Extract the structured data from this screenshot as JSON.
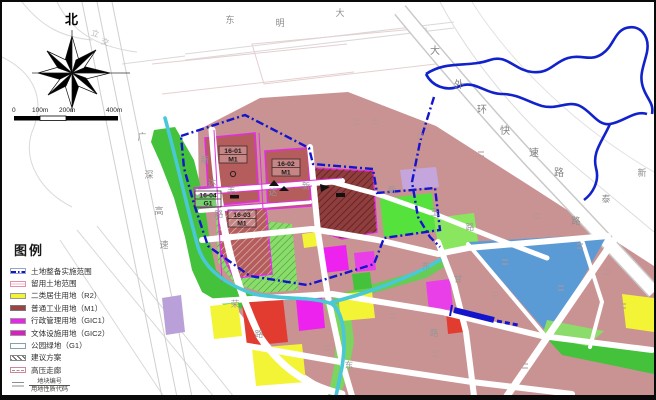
{
  "compass": {
    "north": "北"
  },
  "scalebar": {
    "labels": [
      "0",
      "100m",
      "200m",
      "400m"
    ]
  },
  "legend": {
    "title": "图例",
    "items": [
      {
        "label": "土地整备实施范围",
        "type": "dashdot-line",
        "color": "#1414cc"
      },
      {
        "label": "留用土地范围",
        "type": "outline-pink",
        "color": "#e590a8"
      },
      {
        "label": "二类居住用地（R2）",
        "type": "fill",
        "color": "#f4f436"
      },
      {
        "label": "普通工业用地（M1）",
        "type": "fill",
        "color": "#9c4444"
      },
      {
        "label": "行政管理用地（GIC1）",
        "type": "fill",
        "color": "#ee22ee"
      },
      {
        "label": "文体设施用地（GIC2）",
        "type": "fill",
        "color": "#de1cc6"
      },
      {
        "label": "公园绿地（G1）",
        "type": "outline",
        "color": "#fdfdfd"
      },
      {
        "label": "建议方案",
        "type": "hatch",
        "color": "#555555"
      },
      {
        "label": "高压走廊",
        "type": "outline-dash",
        "color": "#cc8899"
      },
      {
        "label_top": "地块编号",
        "label_bottom": "用地性质代码",
        "type": "fraction"
      }
    ]
  },
  "map": {
    "plots": [
      {
        "id": "16-01",
        "code": "M1"
      },
      {
        "id": "16-02",
        "code": "M1"
      },
      {
        "id": "16-03",
        "code": "M1"
      },
      {
        "id": "16-04",
        "code": "G1"
      }
    ],
    "road_labels": [
      {
        "ch": "东"
      },
      {
        "ch": "明"
      },
      {
        "ch": "大"
      },
      {
        "ch": "大"
      },
      {
        "ch": "外"
      },
      {
        "ch": "环"
      },
      {
        "ch": "快"
      },
      {
        "ch": "速"
      },
      {
        "ch": "路"
      },
      {
        "ch": "新"
      },
      {
        "ch": "泰"
      },
      {
        "ch": "路"
      },
      {
        "ch": "广"
      },
      {
        "ch": "深"
      },
      {
        "ch": "高"
      },
      {
        "ch": "速"
      },
      {
        "ch": "新"
      },
      {
        "ch": "达"
      },
      {
        "ch": "路"
      },
      {
        "ch": "丰"
      },
      {
        "ch": "达"
      },
      {
        "ch": "新"
      },
      {
        "ch": "新"
      },
      {
        "ch": "玉"
      },
      {
        "ch": "路"
      },
      {
        "ch": "东"
      },
      {
        "ch": "甘"
      },
      {
        "ch": "路"
      },
      {
        "ch": "东"
      },
      {
        "ch": "荣"
      },
      {
        "ch": "路"
      },
      {
        "ch": "立"
      },
      {
        "ch": "交"
      }
    ],
    "colors": {
      "boundary_blue": "#1414cc",
      "river_blue": "#1122cc",
      "water_cyan": "#49c8d8",
      "urban_pink": "#c99393",
      "parcel_m1": "#b55c5c",
      "parcel_m1_dark": "#8f3d3d",
      "residential_yellow": "#f4f436",
      "gic_magenta": "#ee22ee",
      "park_green": "#44c23c",
      "blue_parcel": "#5b9bd5",
      "lavender_parcel": "#c4a6dd",
      "red_parcel": "#e23b30"
    }
  }
}
